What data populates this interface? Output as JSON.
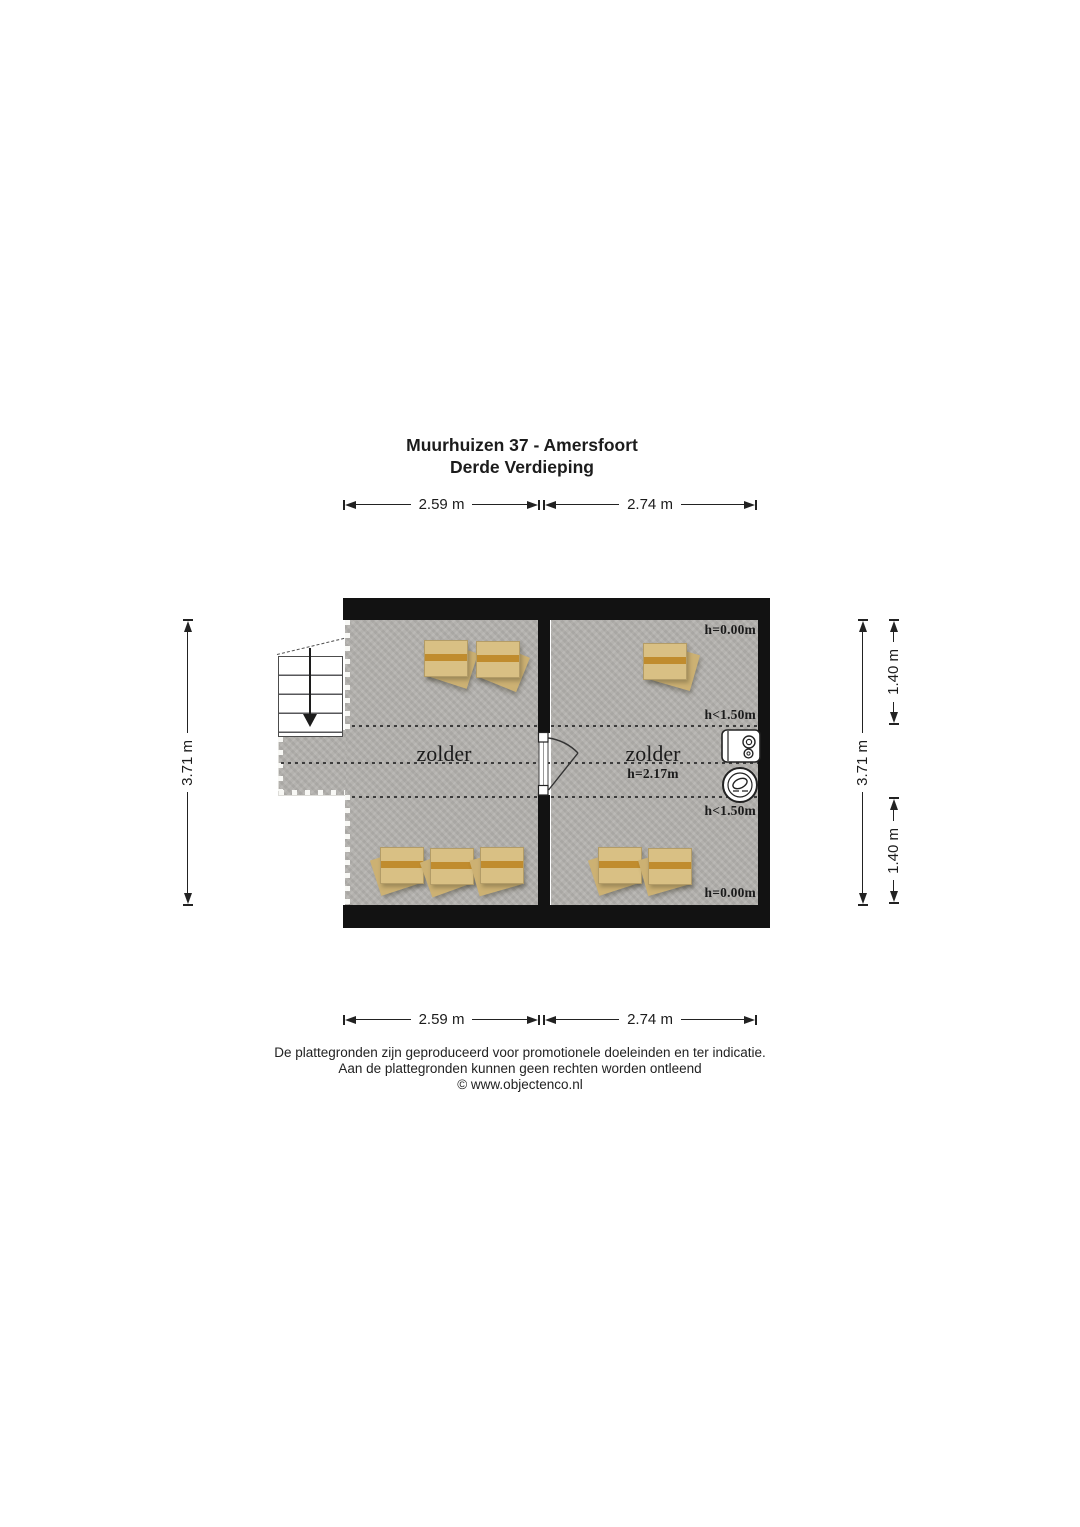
{
  "title": {
    "line1": "Muurhuizen 37 - Amersfoort",
    "line2": "Derde Verdieping"
  },
  "dimensions": {
    "top_left": "2.59 m",
    "top_right": "2.74 m",
    "bottom_left": "2.59 m",
    "bottom_right": "2.74 m",
    "left_height": "3.71 m",
    "right_height": "3.71 m",
    "right_upper": "1.40 m",
    "right_lower": "1.40 m"
  },
  "rooms": {
    "left": {
      "label": "zolder"
    },
    "right": {
      "label": "zolder",
      "ceiling_height": "h=2.17m"
    }
  },
  "annotations": {
    "top_height": "h=0.00m",
    "upper_clearance": "h<1.50m",
    "lower_clearance": "h<1.50m",
    "bottom_height": "h=0.00m"
  },
  "footer": {
    "line1": "De plattegronden zijn geproduceerd voor promotionele doeleinden en ter indicatie.",
    "line2": "Aan de plattegronden kunnen geen rechten worden ontleend",
    "line3": "© www.objectenco.nl"
  },
  "colors": {
    "wall": "#121212",
    "floor": "#b5b3af",
    "box": "#d9c084",
    "tape": "#c08c2e",
    "line": "#222222"
  }
}
